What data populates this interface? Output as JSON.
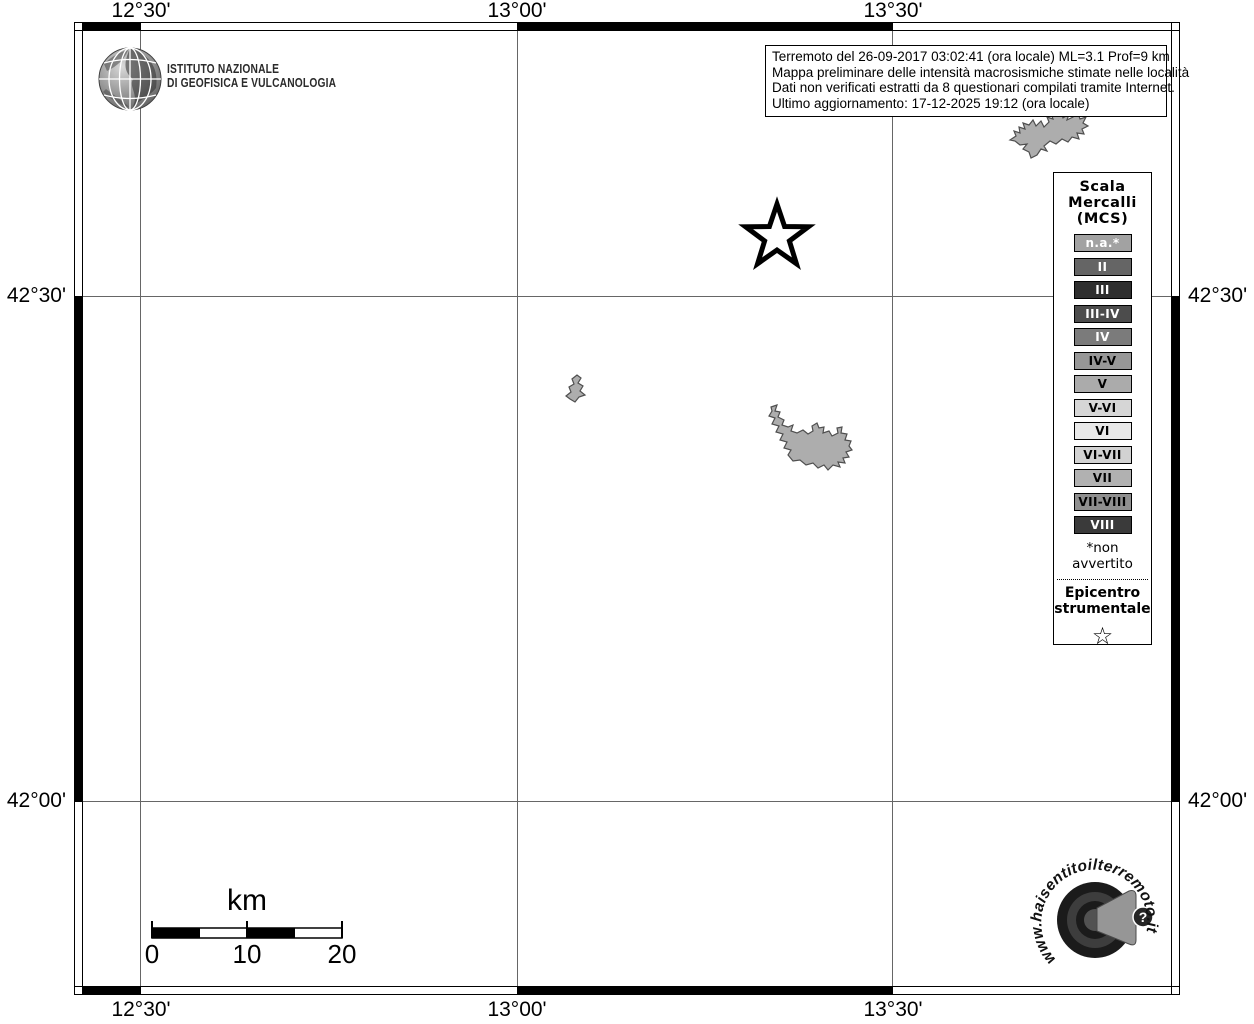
{
  "axes": {
    "lon": [
      "12°30'",
      "13°00'",
      "13°30'"
    ],
    "lat": [
      "42°30'",
      "42°00'"
    ]
  },
  "ingv_logo": {
    "line1": "ISTITUTO NAZIONALE",
    "line2": "DI GEOFISICA E VULCANOLOGIA"
  },
  "infobox": {
    "lines": [
      "Terremoto del 26-09-2017 03:02:41 (ora locale) ML=3.1 Prof=9 km",
      "Mappa preliminare delle intensità macrosismiche stimate nelle località",
      "Dati non verificati estratti da 8 questionari compilati tramite Internet.",
      "Ultimo aggiornamento: 17-12-2025 19:12 (ora locale)"
    ]
  },
  "legend": {
    "title_lines": [
      "Scala",
      "Mercalli",
      "(MCS)"
    ],
    "items": [
      {
        "label": "n.a.*",
        "bg": "#a2a2a2",
        "fg": "#ffffff"
      },
      {
        "label": "II",
        "bg": "#656565",
        "fg": "#ffffff"
      },
      {
        "label": "III",
        "bg": "#2e2e2e",
        "fg": "#ffffff"
      },
      {
        "label": "III-IV",
        "bg": "#4c4c4c",
        "fg": "#ffffff"
      },
      {
        "label": "IV",
        "bg": "#7b7b7b",
        "fg": "#ffffff"
      },
      {
        "label": "IV-V",
        "bg": "#979797",
        "fg": "#000000"
      },
      {
        "label": "V",
        "bg": "#ababab",
        "fg": "#000000"
      },
      {
        "label": "V-VI",
        "bg": "#d6d6d6",
        "fg": "#000000"
      },
      {
        "label": "VI",
        "bg": "#e9e9e9",
        "fg": "#000000"
      },
      {
        "label": "VI-VII",
        "bg": "#d2d2d2",
        "fg": "#000000"
      },
      {
        "label": "VII",
        "bg": "#b1b1b1",
        "fg": "#000000"
      },
      {
        "label": "VII-VIII",
        "bg": "#8f8f8f",
        "fg": "#000000"
      },
      {
        "label": "VIII",
        "bg": "#3a3a3a",
        "fg": "#ffffff"
      }
    ],
    "footnote": "*non avvertito",
    "epicenter_lines": [
      "Epicentro",
      "strumentale"
    ],
    "epicenter_star": "☆"
  },
  "scalebar": {
    "title": "km",
    "tick_labels": [
      "0",
      "10",
      "20"
    ]
  },
  "hsit_logo": {
    "url_text": "www.haisentitoilterremoto.it",
    "question_mark": "?"
  },
  "colors": {
    "lake_fill": "#adadad",
    "lake_stroke": "#4f4f4f",
    "grid_line": "#666666",
    "frame_black": "#000000"
  }
}
